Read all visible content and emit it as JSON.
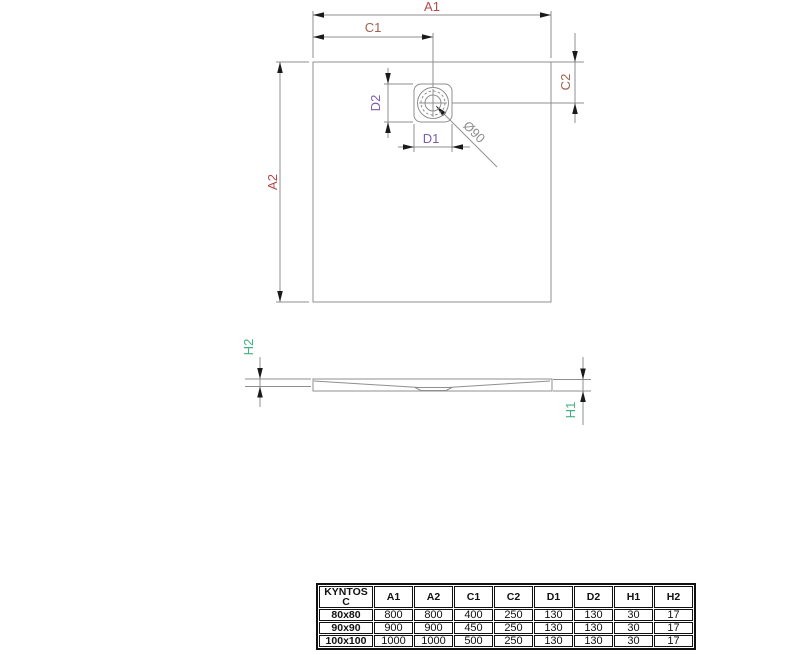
{
  "drawing": {
    "plan": {
      "labels": {
        "a1": "A1",
        "c1": "C1",
        "a2": "A2",
        "c2": "C2",
        "d1": "D1",
        "d2": "D2",
        "drain_diameter": "Ø90"
      }
    },
    "profile": {
      "labels": {
        "h1": "H1",
        "h2": "H2"
      }
    },
    "colors": {
      "a_dims": "#b5494a",
      "c_dims": "#9c6250",
      "d_dims": "#7a5fae",
      "h_dims": "#44b182",
      "drawing_lines": "#8f8f8f",
      "arrows": "#1a1a1a",
      "diameter_text": "#8f8f8f",
      "table_border": "#111111"
    }
  },
  "table": {
    "title_cell": "KYNTOS C",
    "headers": [
      "A1",
      "A2",
      "C1",
      "C2",
      "D1",
      "D2",
      "H1",
      "H2"
    ],
    "rows": [
      {
        "model": "80x80",
        "values": [
          "800",
          "800",
          "400",
          "250",
          "130",
          "130",
          "30",
          "17"
        ]
      },
      {
        "model": "90x90",
        "values": [
          "900",
          "900",
          "450",
          "250",
          "130",
          "130",
          "30",
          "17"
        ]
      },
      {
        "model": "100x100",
        "values": [
          "1000",
          "1000",
          "500",
          "250",
          "130",
          "130",
          "30",
          "17"
        ]
      }
    ]
  }
}
